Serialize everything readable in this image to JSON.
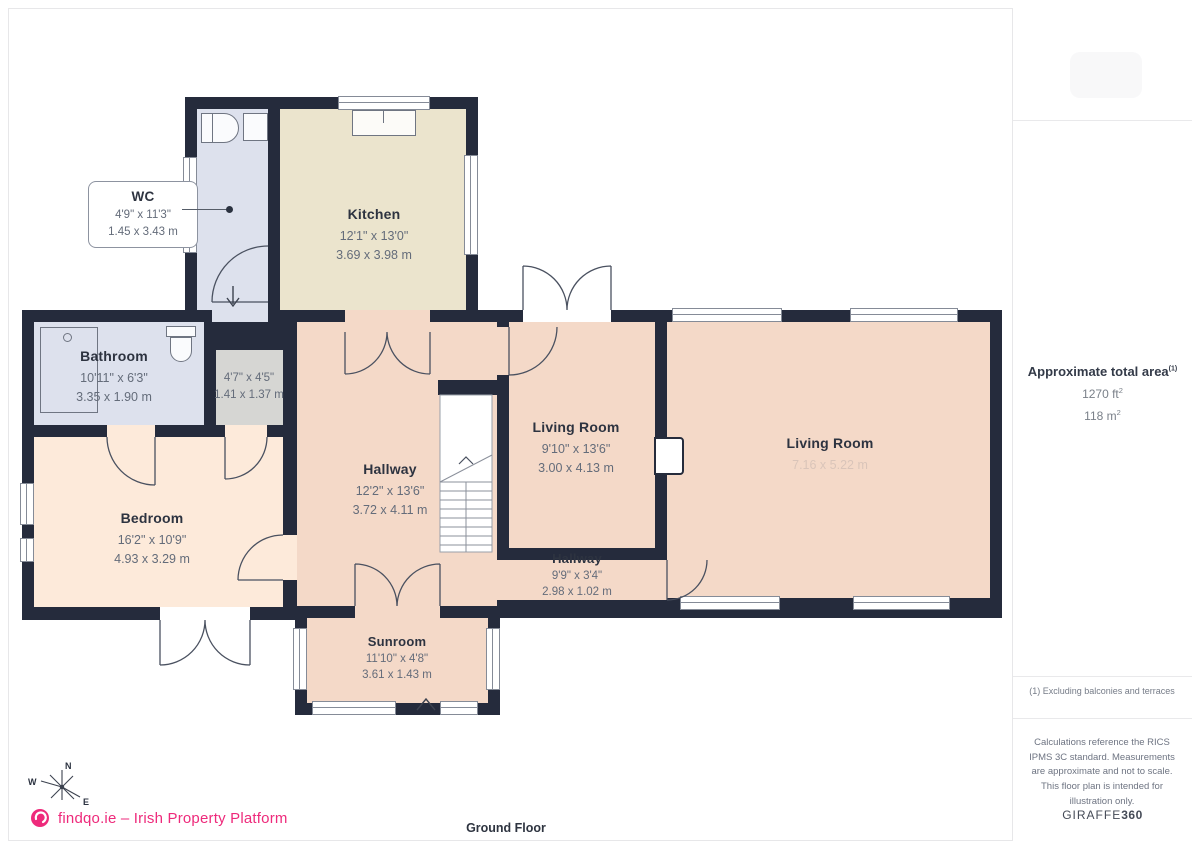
{
  "meta": {
    "floor_label": "Ground Floor"
  },
  "branding": {
    "logo_text": "findqo.ie – Irish Property Platform",
    "brand_color": "#ee2a7b",
    "giraffe_light": "GIRAFFE",
    "giraffe_bold": "360"
  },
  "sidebar": {
    "total_area": {
      "title": "Approximate total area",
      "title_sup": "(1)",
      "ft_value": "1270 ft",
      "ft_sup": "2",
      "m_value": "118 m",
      "m_sup": "2"
    },
    "footnote": "(1) Excluding balconies and terraces",
    "disclaimer": "Calculations reference the RICS IPMS 3C standard. Measurements are approximate and not to scale. This floor plan is intended for illustration only."
  },
  "compass": {
    "n": "N",
    "w": "W",
    "e": "E"
  },
  "rooms": [
    {
      "name": "WC",
      "imperial": "4'9\" x 11'3\"",
      "metric": "1.45 x 3.43 m"
    },
    {
      "name": "Kitchen",
      "imperial": "12'1\" x 13'0\"",
      "metric": "3.69 x 3.98 m"
    },
    {
      "name": "Bathroom",
      "imperial": "10'11\" x 6'3\"",
      "metric": "3.35 x 1.90 m"
    },
    {
      "name": "",
      "imperial": "4'7\" x 4'5\"",
      "metric": "1.41 x 1.37 m"
    },
    {
      "name": "Bedroom",
      "imperial": "16'2\" x 10'9\"",
      "metric": "4.93 x 3.29 m"
    },
    {
      "name": "Hallway",
      "imperial": "12'2\" x 13'6\"",
      "metric": "3.72 x 4.11 m"
    },
    {
      "name": "Living Room",
      "imperial": "9'10\" x 13'6\"",
      "metric": "3.00 x 4.13 m"
    },
    {
      "name": "Living Room",
      "imperial": "",
      "metric": "7.16 x 5.22 m"
    },
    {
      "name": "Hallway",
      "imperial": "9'9\" x 3'4\"",
      "metric": "2.98 x 1.02 m"
    },
    {
      "name": "Sunroom",
      "imperial": "11'10\" x 4'8\"",
      "metric": "3.61 x 1.43 m"
    }
  ],
  "colors": {
    "wall": "#252b3c",
    "room_blue": "#dde1ed",
    "room_beige": "#ebe4cd",
    "room_gray": "#d6d6d3",
    "room_peach": "#fdeada",
    "room_pink": "#f4d9c8",
    "brand": "#ee2a7b"
  }
}
